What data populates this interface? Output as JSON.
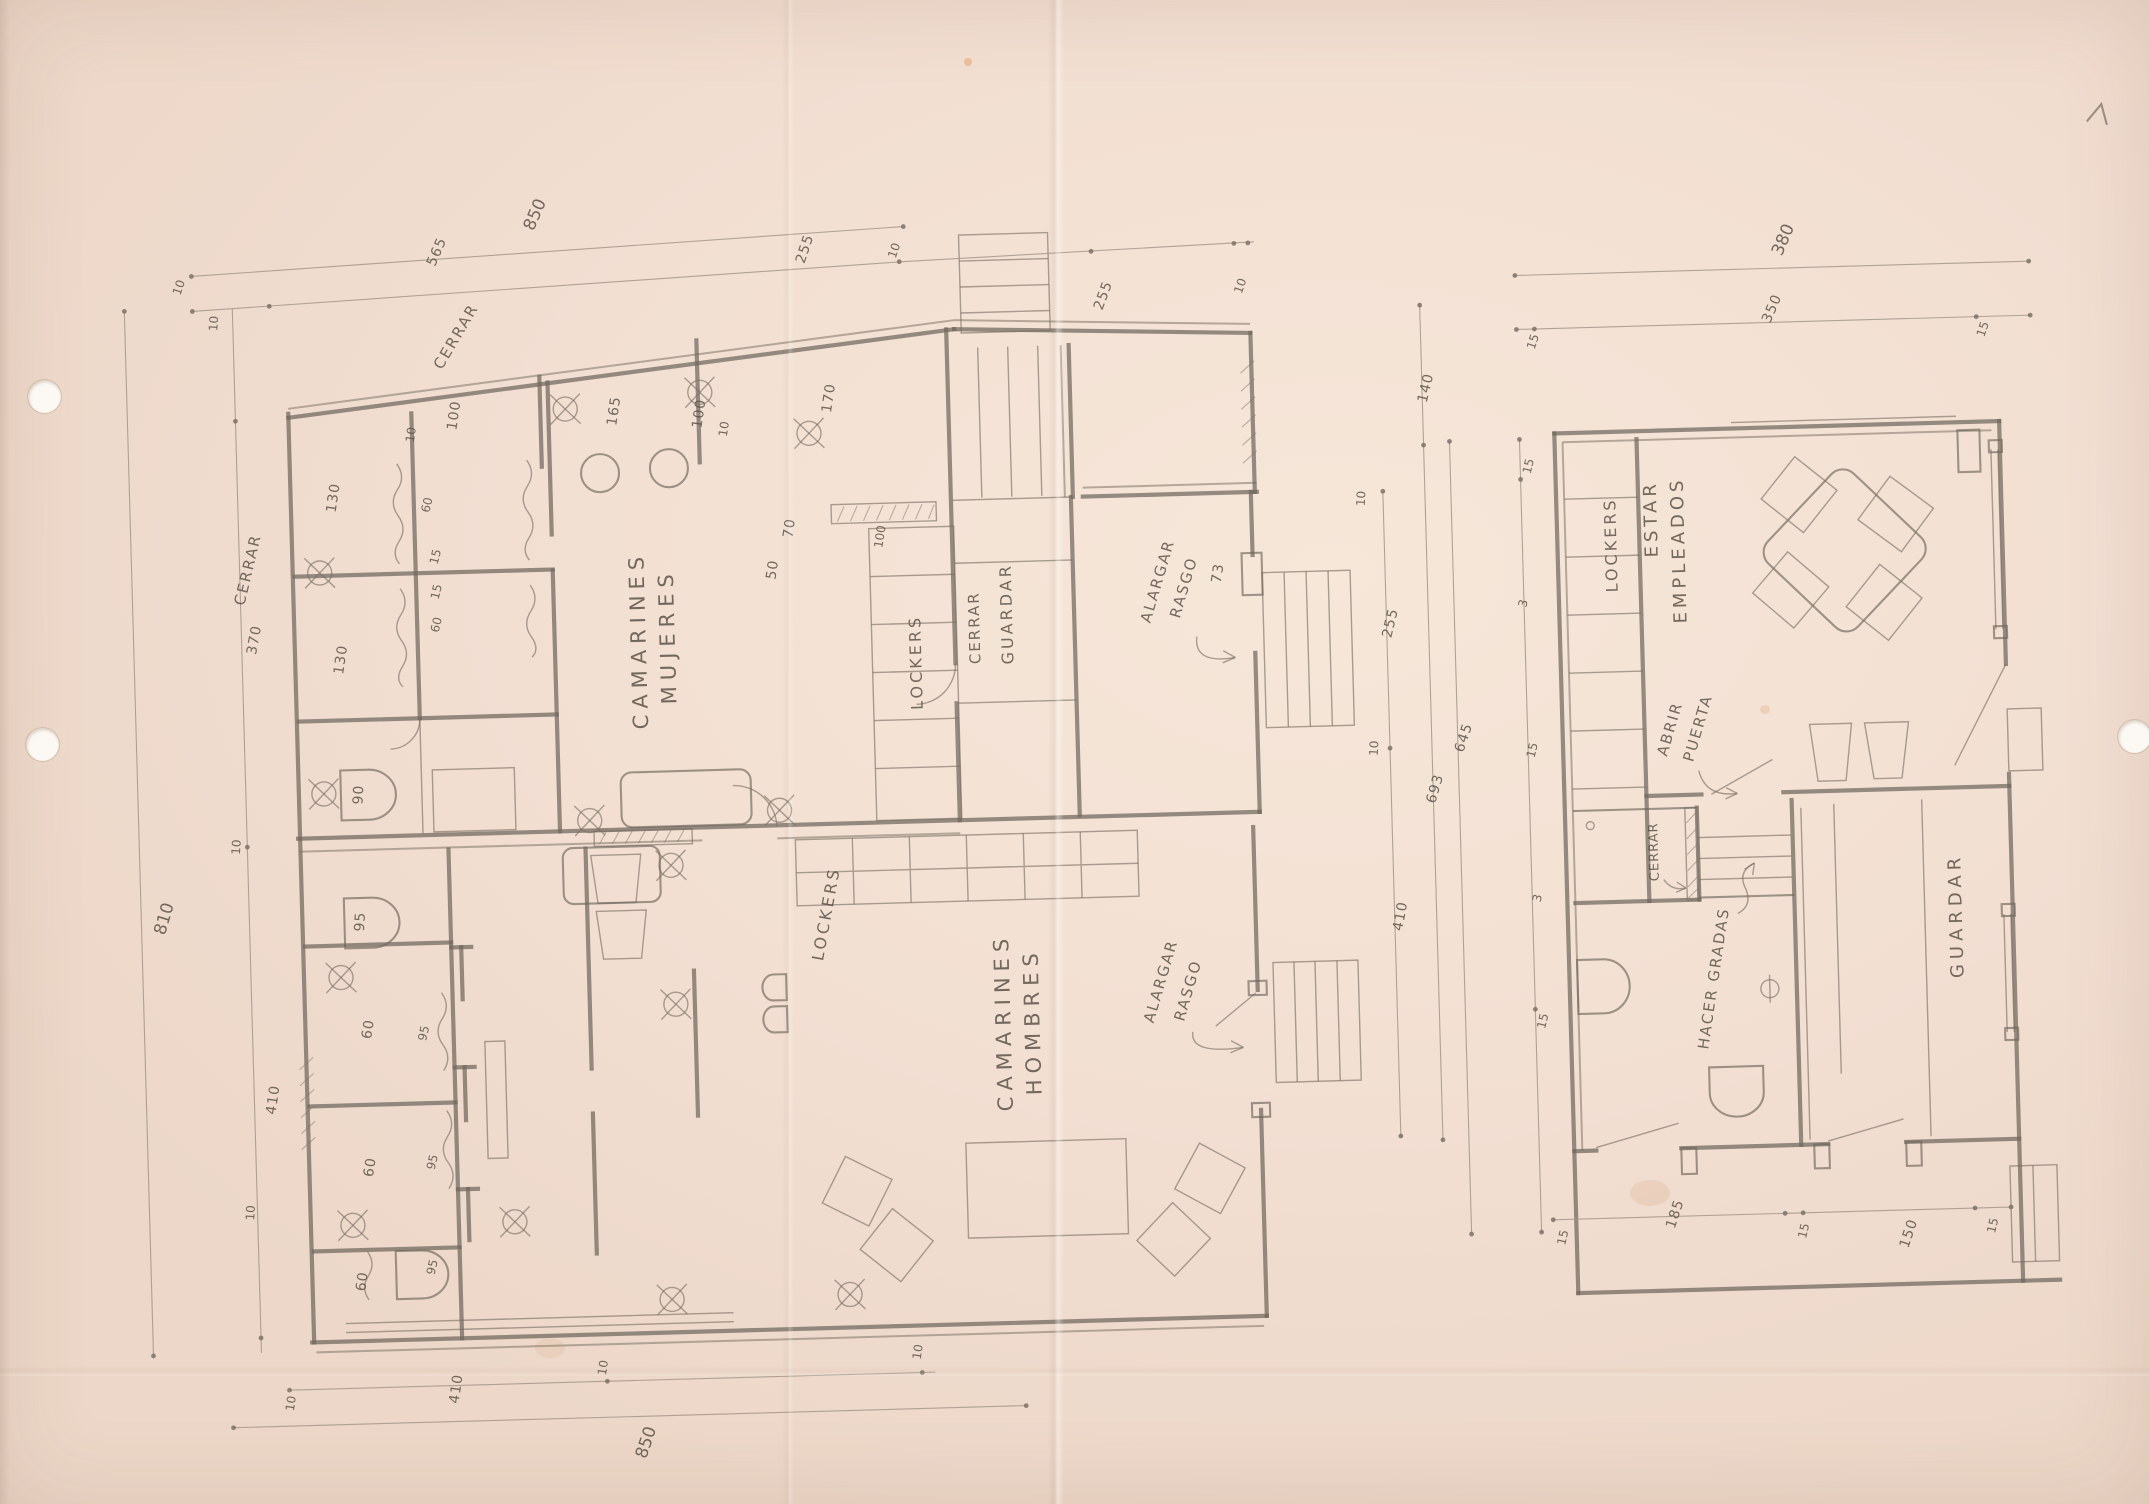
{
  "colors": {
    "paper": "#f2dfd2",
    "pencil": "#6f675d",
    "dim_pencil": "#a3978a",
    "text_graphite": "#5a5248",
    "hole": "#fcf9f4"
  },
  "icons": {
    "corner_mark": "pencil-check",
    "hole_punch": "punched-hole",
    "crossed_circle": "drain-symbol",
    "wavy_line": "shower-curtain"
  },
  "left_plan": {
    "rooms": {
      "mujeres_l1": "CAMARINES",
      "mujeres_l2": "MUJERES",
      "hombres_l1": "CAMARINES",
      "hombres_l2": "HOMBRES",
      "lockers_women": "LOCKERS",
      "lockers_men": "LOCKERS",
      "closet_cerrar": "CERRAR",
      "closet_guardar": "GUARDAR"
    },
    "annotations": {
      "cerrar_top": "CERRAR",
      "cerrar_left": "CERRAR",
      "alargar1_l1": "ALARGAR",
      "alargar1_l2": "RASGO",
      "alargar2_l1": "ALARGAR",
      "alargar2_l2": "RASGO"
    },
    "dims": {
      "top_total": "850",
      "top": [
        "10",
        "565",
        "255",
        "10"
      ],
      "top_right": [
        "255",
        "10"
      ],
      "left_total": "810",
      "left": [
        "10",
        "370",
        "10",
        "410",
        "10"
      ],
      "bottom_total": "850",
      "bottom": [
        "10",
        "410",
        "10",
        "10"
      ],
      "right": [
        "10",
        "255",
        "10",
        "410"
      ],
      "right_140": "140",
      "right_total": "693",
      "inner": [
        "130",
        "100",
        "10",
        "165",
        "100",
        "10",
        "170",
        "60",
        "15",
        "15",
        "60",
        "70",
        "50",
        "130",
        "90",
        "100",
        "73",
        "95",
        "60",
        "95",
        "60",
        "95",
        "60",
        "95"
      ]
    }
  },
  "right_plan": {
    "rooms": {
      "lockers": "LOCKERS",
      "estar_l1": "ESTAR",
      "estar_l2": "EMPLEADOS",
      "cerrar": "CERRAR",
      "guardar": "GUARDAR"
    },
    "annotations": {
      "abrir_l1": "ABRIR",
      "abrir_l2": "PUERTA",
      "hacer_gradas": "HACER GRADAS"
    },
    "dims": {
      "top_total": "380",
      "top": [
        "15",
        "350",
        "15"
      ],
      "left_total": "645",
      "left": [
        "15",
        "3",
        "15",
        "3",
        "15"
      ],
      "bottom": [
        "15",
        "185",
        "15",
        "150",
        "15"
      ]
    }
  }
}
